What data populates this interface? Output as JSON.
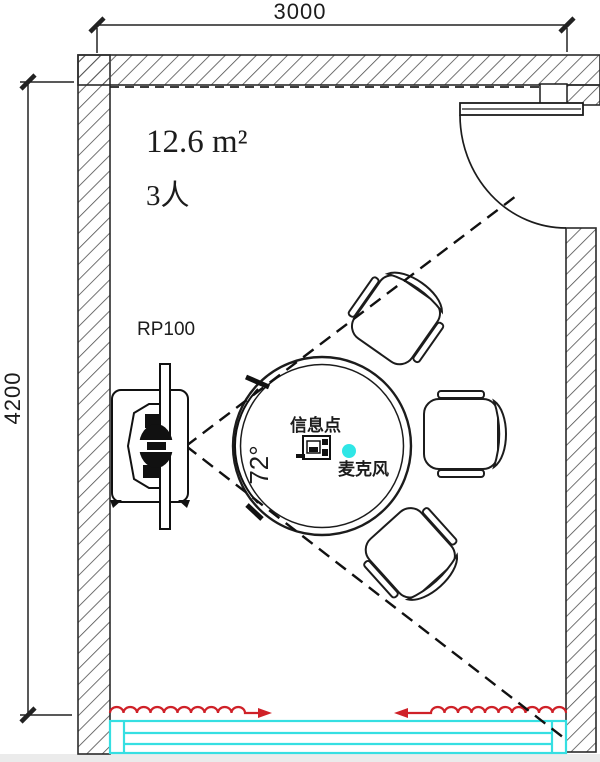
{
  "dimensions": {
    "top": "3000",
    "left": "4200"
  },
  "room": {
    "area": "12.6 m²",
    "capacity": "3人"
  },
  "labels": {
    "device": "RP100",
    "angle": "72°",
    "info_point": "信息点",
    "microphone": "麦克风"
  },
  "colors": {
    "line": "#1c1c1c",
    "window": "#35dfe2",
    "curtain_arrow": "#cf2128",
    "mic_dot": "#2fe6e6"
  }
}
